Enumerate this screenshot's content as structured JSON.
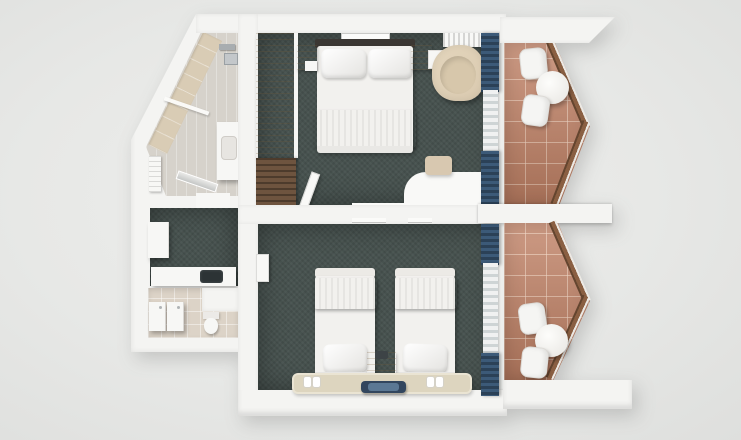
{
  "scene": {
    "kind": "3d-floorplan-top-view-render",
    "description": "Top-down 3D render of a hotel suite floor plan: double-bed room and twin-bed room with terracotta balconies, two bathrooms and an entry hall",
    "rooms": [
      {
        "id": "bathroom-angled",
        "items": [
          "glass-shower-screen",
          "shower-drain",
          "chrome-fixtures",
          "vanity-sink",
          "towel-radiator",
          "beige-tile-band"
        ]
      },
      {
        "id": "entry-hall",
        "items": [
          "white-cabinet",
          "kitchenette-counter",
          "dark-sink"
        ]
      },
      {
        "id": "bathroom-lower",
        "items": [
          "toilet",
          "vanity-unit-1",
          "vanity-unit-2",
          "tiled-floor"
        ]
      },
      {
        "id": "bedroom-double",
        "items": [
          "double-bed",
          "pillow-left",
          "pillow-right",
          "blue-runner",
          "dark-headboard",
          "nightstand-left",
          "nightstand-right",
          "phone",
          "wardrobe",
          "luggage-bench",
          "entry-door",
          "wall-art",
          "ac-unit",
          "armchair",
          "desk",
          "desk-chair",
          "tv-mark",
          "navy-curtains",
          "sheer-curtain"
        ]
      },
      {
        "id": "bedroom-twin",
        "items": [
          "single-bed-left",
          "single-bed-right",
          "blue-runner-left",
          "blue-runner-right",
          "pillow-left",
          "pillow-right",
          "nightstand",
          "phone",
          "rug",
          "slippers-left-pair",
          "slippers-right-pair",
          "navy-bench-mat",
          "entry-door",
          "tv-marks",
          "navy-curtains",
          "sheer-curtain"
        ]
      },
      {
        "id": "balcony-upper",
        "items": [
          "round-table",
          "chair-north",
          "chair-south",
          "angled-railing",
          "terracotta-tiles"
        ]
      },
      {
        "id": "balcony-lower",
        "items": [
          "round-table",
          "chair-north",
          "chair-south",
          "angled-railing",
          "terracotta-tiles"
        ]
      }
    ]
  },
  "colors": {
    "wall": "#f4f4f2",
    "wall_shade": "#dddddb",
    "carpet": "#47524f",
    "bath_floor": "#d6d2cb",
    "bath_tile_band": "#d9ccb5",
    "bath2_floor": "#dcd3c7",
    "wood_light": "#d2c09a",
    "wood_dark": "#6e543f",
    "terracotta": "#c08165",
    "rail_wood": "#8a5f42",
    "curtain_navy": "#3c5a78",
    "curtain_navy_dark": "#2b4157",
    "sheer": "#f0f1f1",
    "sheer_shade": "#ced4d5",
    "blanket_blue": "#7394b1",
    "blanket_blue_dark": "#5d7fa0",
    "headboard": "#3b3733",
    "furn_white": "#f7f7f5",
    "beige_chair": "#d9c9af",
    "rug": "#ddd5bf",
    "mat_navy": "#32465e",
    "mat_inner": "#5b7894",
    "sink_dark": "#2c3335",
    "chrome": "#a8adb0"
  }
}
